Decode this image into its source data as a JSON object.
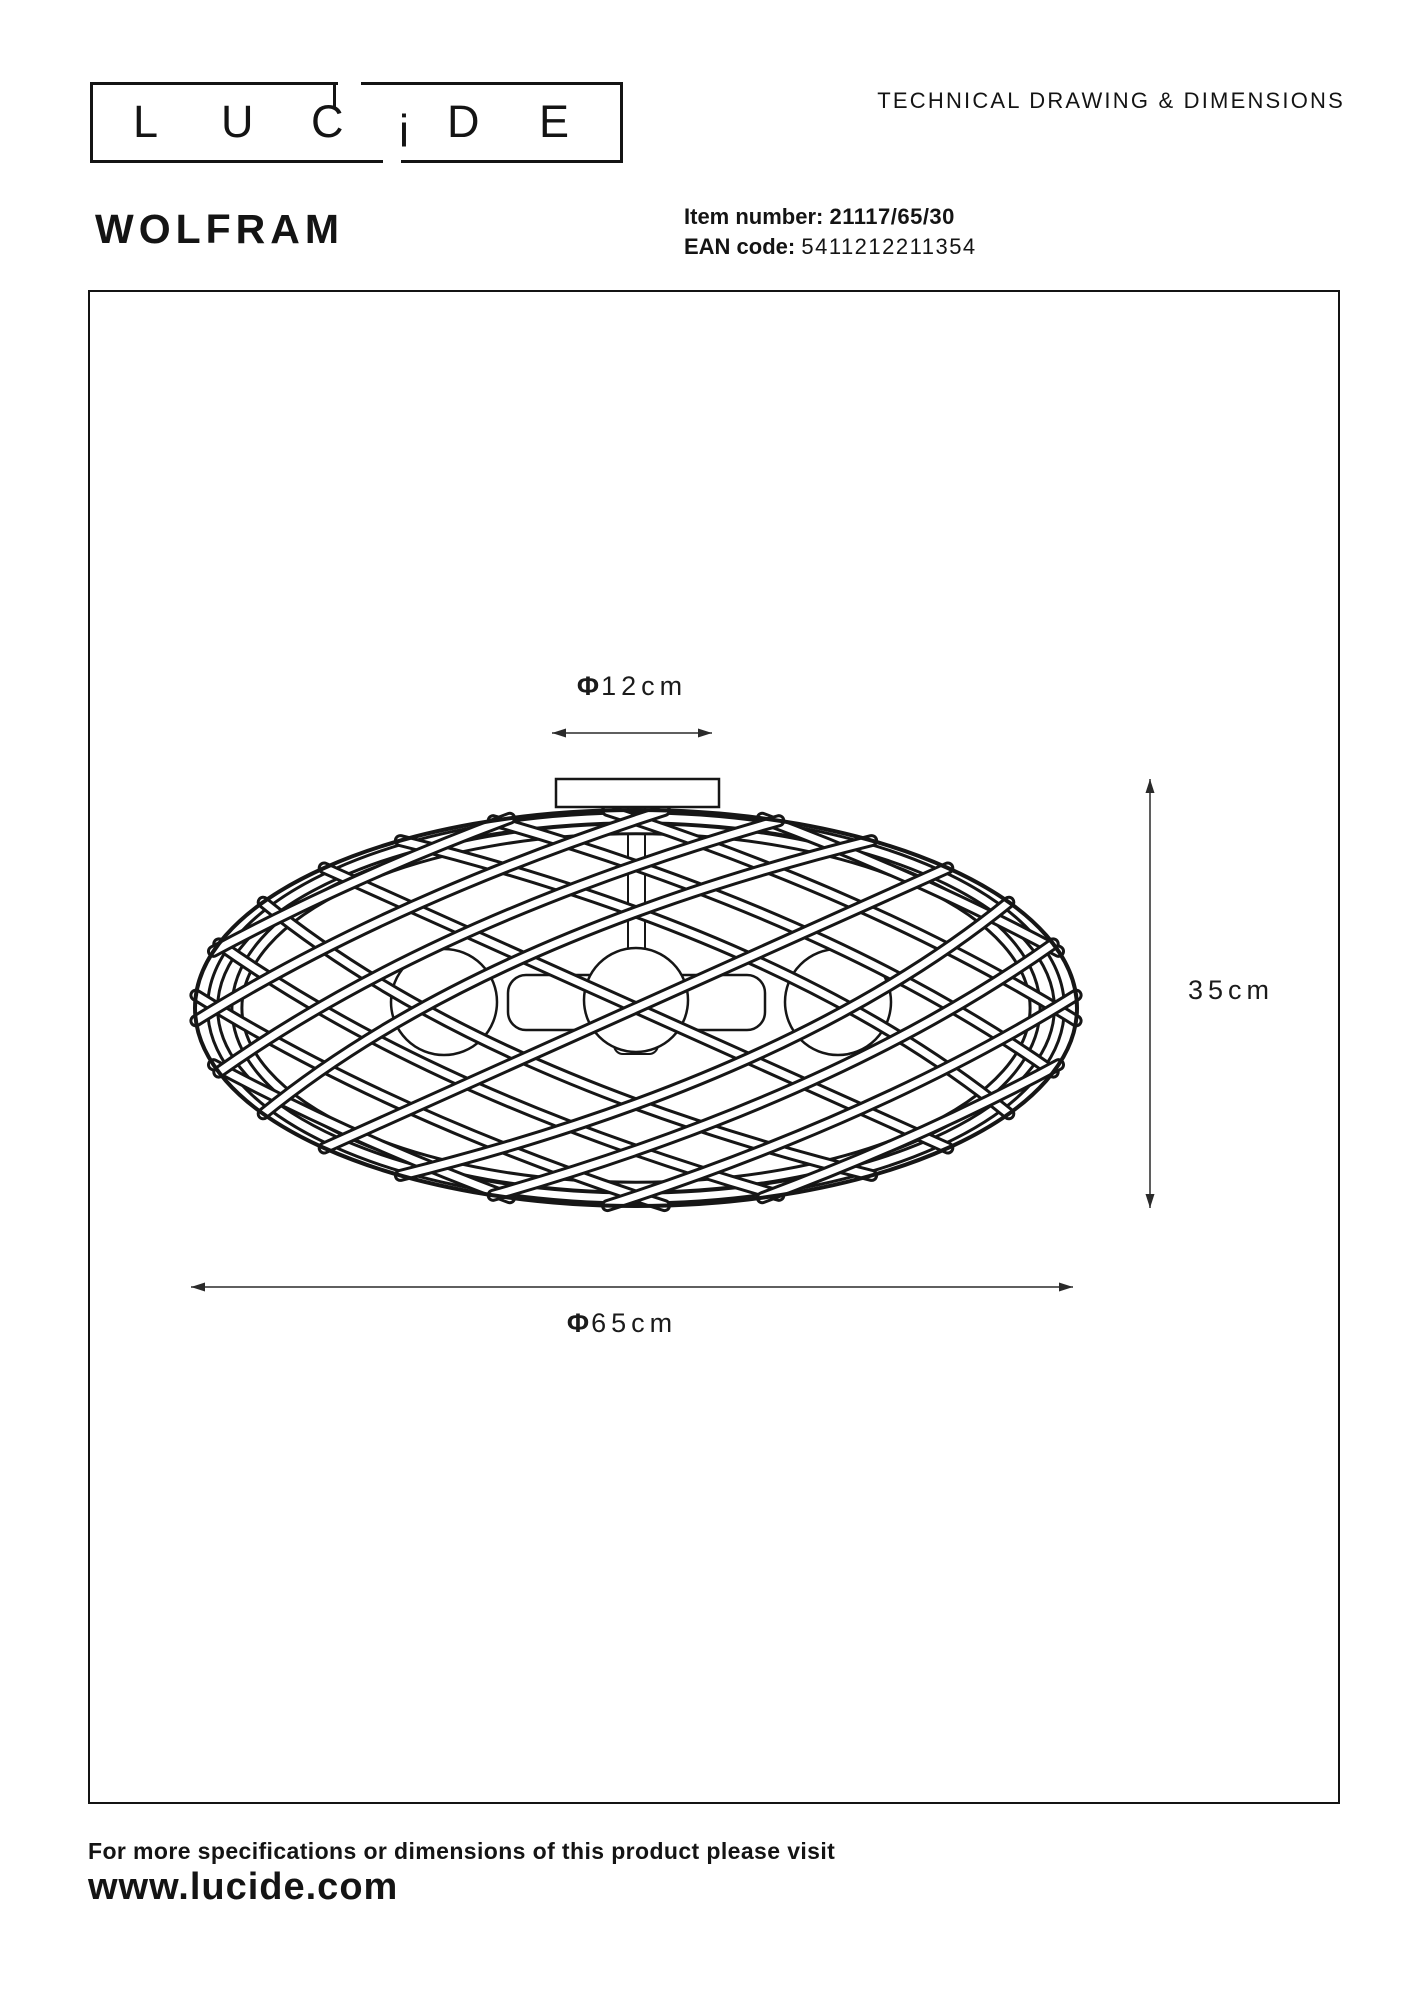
{
  "header": {
    "logo_letters": [
      "L",
      "U",
      "C",
      "i",
      "D",
      "E"
    ],
    "doc_title": "TECHNICAL DRAWING & DIMENSIONS"
  },
  "product": {
    "name": "WOLFRAM",
    "item_label": "Item number:",
    "item_value": "21117/65/30",
    "ean_label": "EAN code:",
    "ean_value": "5411212211354"
  },
  "drawing": {
    "dim_top": {
      "phi": "Φ",
      "value": "12cm"
    },
    "dim_right": {
      "phi": "",
      "value": "35cm"
    },
    "dim_bottom": {
      "phi": "Φ",
      "value": "65cm"
    }
  },
  "footer": {
    "line1": "For more specifications or dimensions of this product please visit",
    "line2": "www.lucide.com"
  },
  "colors": {
    "ink": "#161616",
    "paper": "#ffffff",
    "dim_line": "#2a2a2a"
  }
}
